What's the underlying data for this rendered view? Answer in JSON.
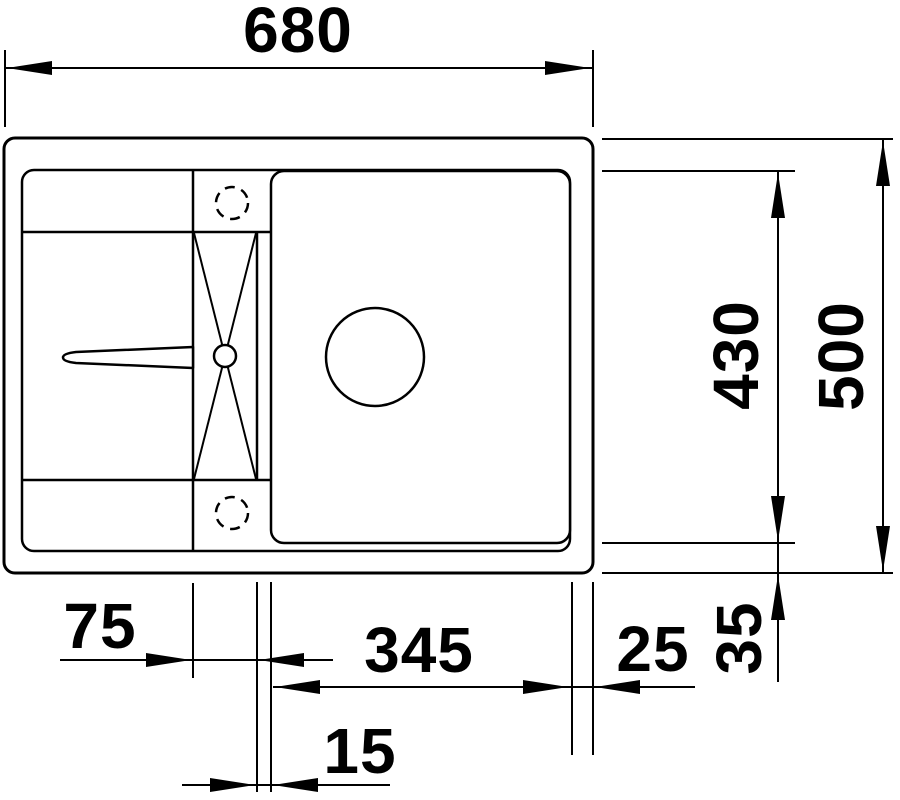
{
  "drawing": {
    "kind_label": "sink-plan-dimension-drawing",
    "colors": {
      "line": "#000000",
      "background": "#ffffff"
    },
    "dimensions": {
      "overall_width": "680",
      "overall_depth": "500",
      "bowl_length": "430",
      "bowl_bottom_gap": "35",
      "ledge_width": "75",
      "bowl_width": "345",
      "bowl_right_gap": "25",
      "step_width": "15"
    }
  }
}
